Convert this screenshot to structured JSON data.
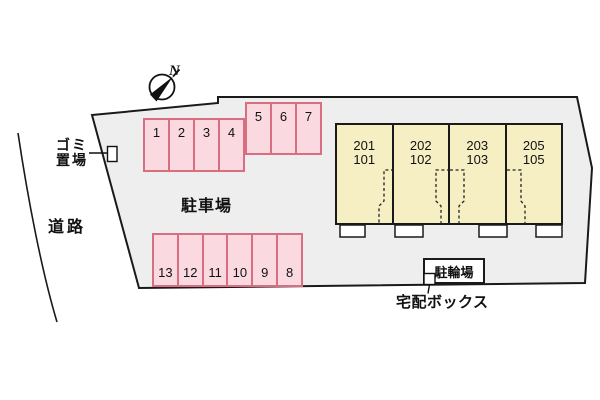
{
  "compass": {
    "north_label": "N"
  },
  "labels": {
    "road": "道路",
    "garbage_line1": "ゴミ",
    "garbage_line2": "置場",
    "parking_lot": "駐車場",
    "bicycle_parking": "駐輪場",
    "delivery_box": "宅配ボックス"
  },
  "parking": {
    "row_top": [
      "1",
      "2",
      "3",
      "4"
    ],
    "row_upper": [
      "5",
      "6",
      "7"
    ],
    "row_bottom": [
      "13",
      "12",
      "11",
      "10",
      "9",
      "8"
    ]
  },
  "building": {
    "units": [
      {
        "upper": "201",
        "lower": "101"
      },
      {
        "upper": "202",
        "lower": "102"
      },
      {
        "upper": "203",
        "lower": "103"
      },
      {
        "upper": "205",
        "lower": "105"
      }
    ]
  },
  "colors": {
    "site_fill": "#eeeeee",
    "outline": "#1a1a1a",
    "parking_fill": "#fbd9e0",
    "parking_border": "#d96e80",
    "building_fill": "#f6efc4"
  }
}
